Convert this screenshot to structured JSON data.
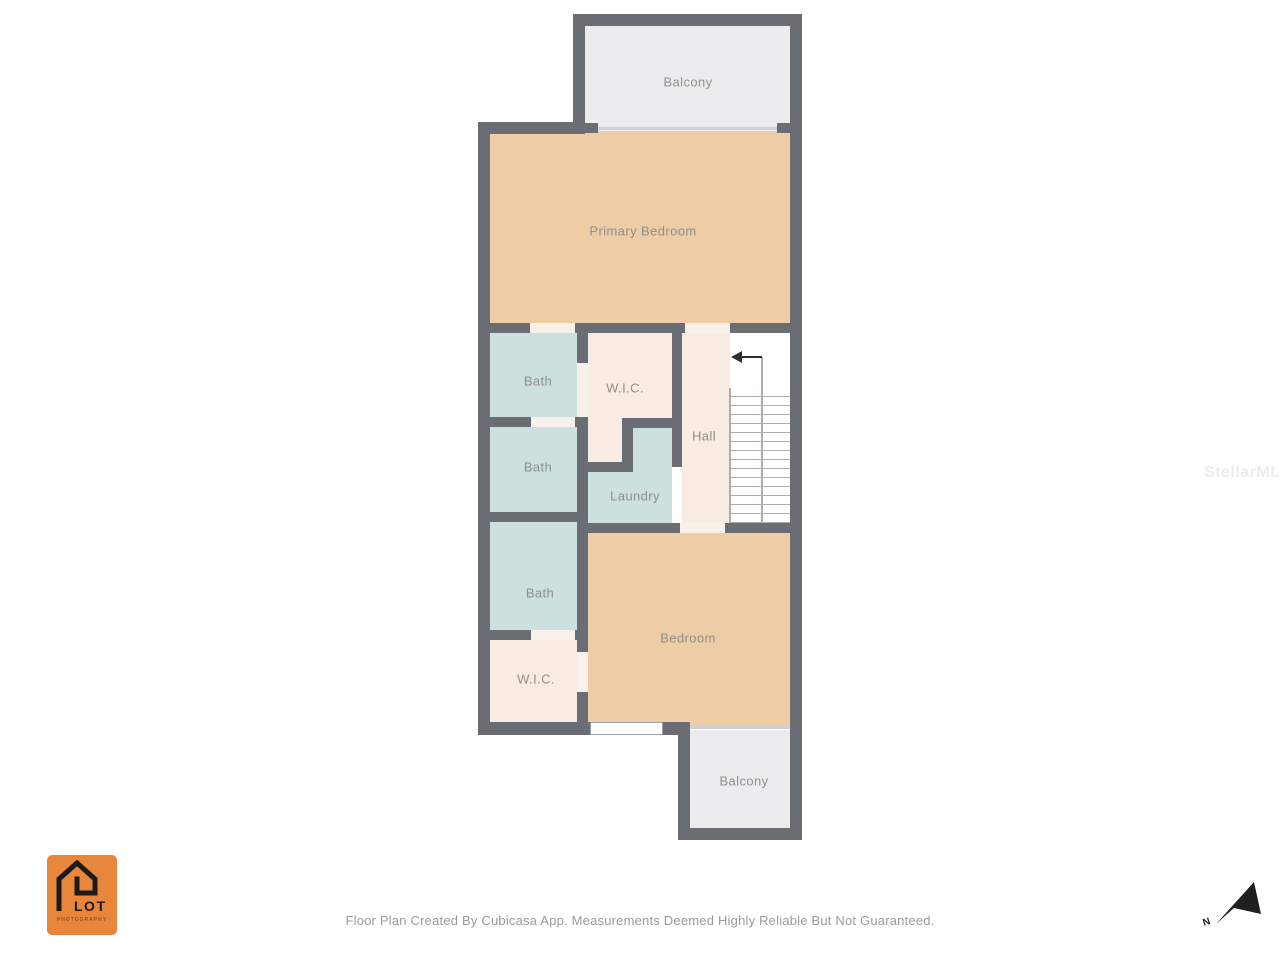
{
  "rooms": {
    "balcony_top": "Balcony",
    "primary_bedroom": "Primary Bedroom",
    "bath_1": "Bath",
    "wic_1": "W.I.C.",
    "hall": "Hall",
    "bath_2": "Bath",
    "laundry": "Laundry",
    "bath_3": "Bath",
    "bedroom": "Bedroom",
    "wic_2": "W.I.C.",
    "balcony_bottom": "Balcony"
  },
  "footer": {
    "disclaimer": "Floor Plan Created By Cubicasa App. Measurements Deemed Highly Reliable But Not Guaranteed."
  },
  "logo": {
    "name": "LOT",
    "subtitle": "PHOTOGRAPHY"
  },
  "compass": {
    "north_label": "N"
  },
  "watermark": "StellarMLS",
  "colors": {
    "wall": "#6a6e74",
    "bedroom_fill": "#edcca6",
    "bath_fill": "#cde0e0",
    "closet_fill": "#f8ece2",
    "balcony_fill": "#ececee",
    "label_text": "#8f8e8c",
    "logo_orange": "#e8873b"
  }
}
